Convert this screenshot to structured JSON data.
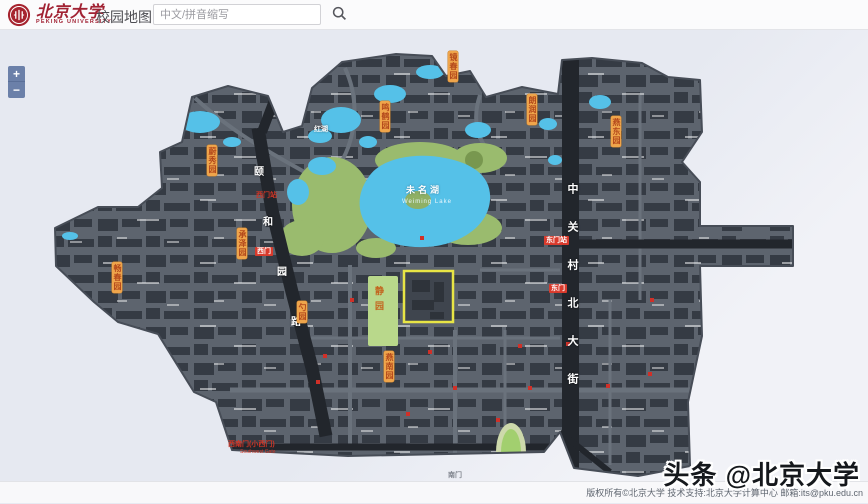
{
  "header": {
    "brand_cn": "北京大学",
    "brand_en": "PEKING UNIVERSITY",
    "app_title": "校园地图",
    "search": {
      "placeholder": "中文/拼音缩写",
      "value": ""
    }
  },
  "controls": {
    "zoom_in": "+",
    "zoom_out": "−"
  },
  "map": {
    "lake_cn": "未名湖",
    "lake_en": "Weiming Lake",
    "red_lake": "红湖",
    "lawn": "静园",
    "road_right": "中关村北大街",
    "road_left_chars": [
      "颐",
      "和",
      "园",
      "路"
    ],
    "gardens": [
      "蔚秀园",
      "承泽园",
      "畅春园",
      "勺园",
      "鸣鹤园",
      "镜春园",
      "朗润园",
      "燕东园",
      "燕南园"
    ],
    "gates": {
      "west_station": "西门站",
      "west": "西门",
      "east_station": "东门站",
      "east": "东门",
      "southwest": "西南门(小西门)",
      "southwest_en": "Southwest Gate",
      "south": "南门"
    }
  },
  "footer": {
    "copyright": "版权所有©北京大学 技术支持:北京大学计算中心 邮箱:its@pku.edu.cn"
  },
  "watermark": "头条 @北京大学"
}
